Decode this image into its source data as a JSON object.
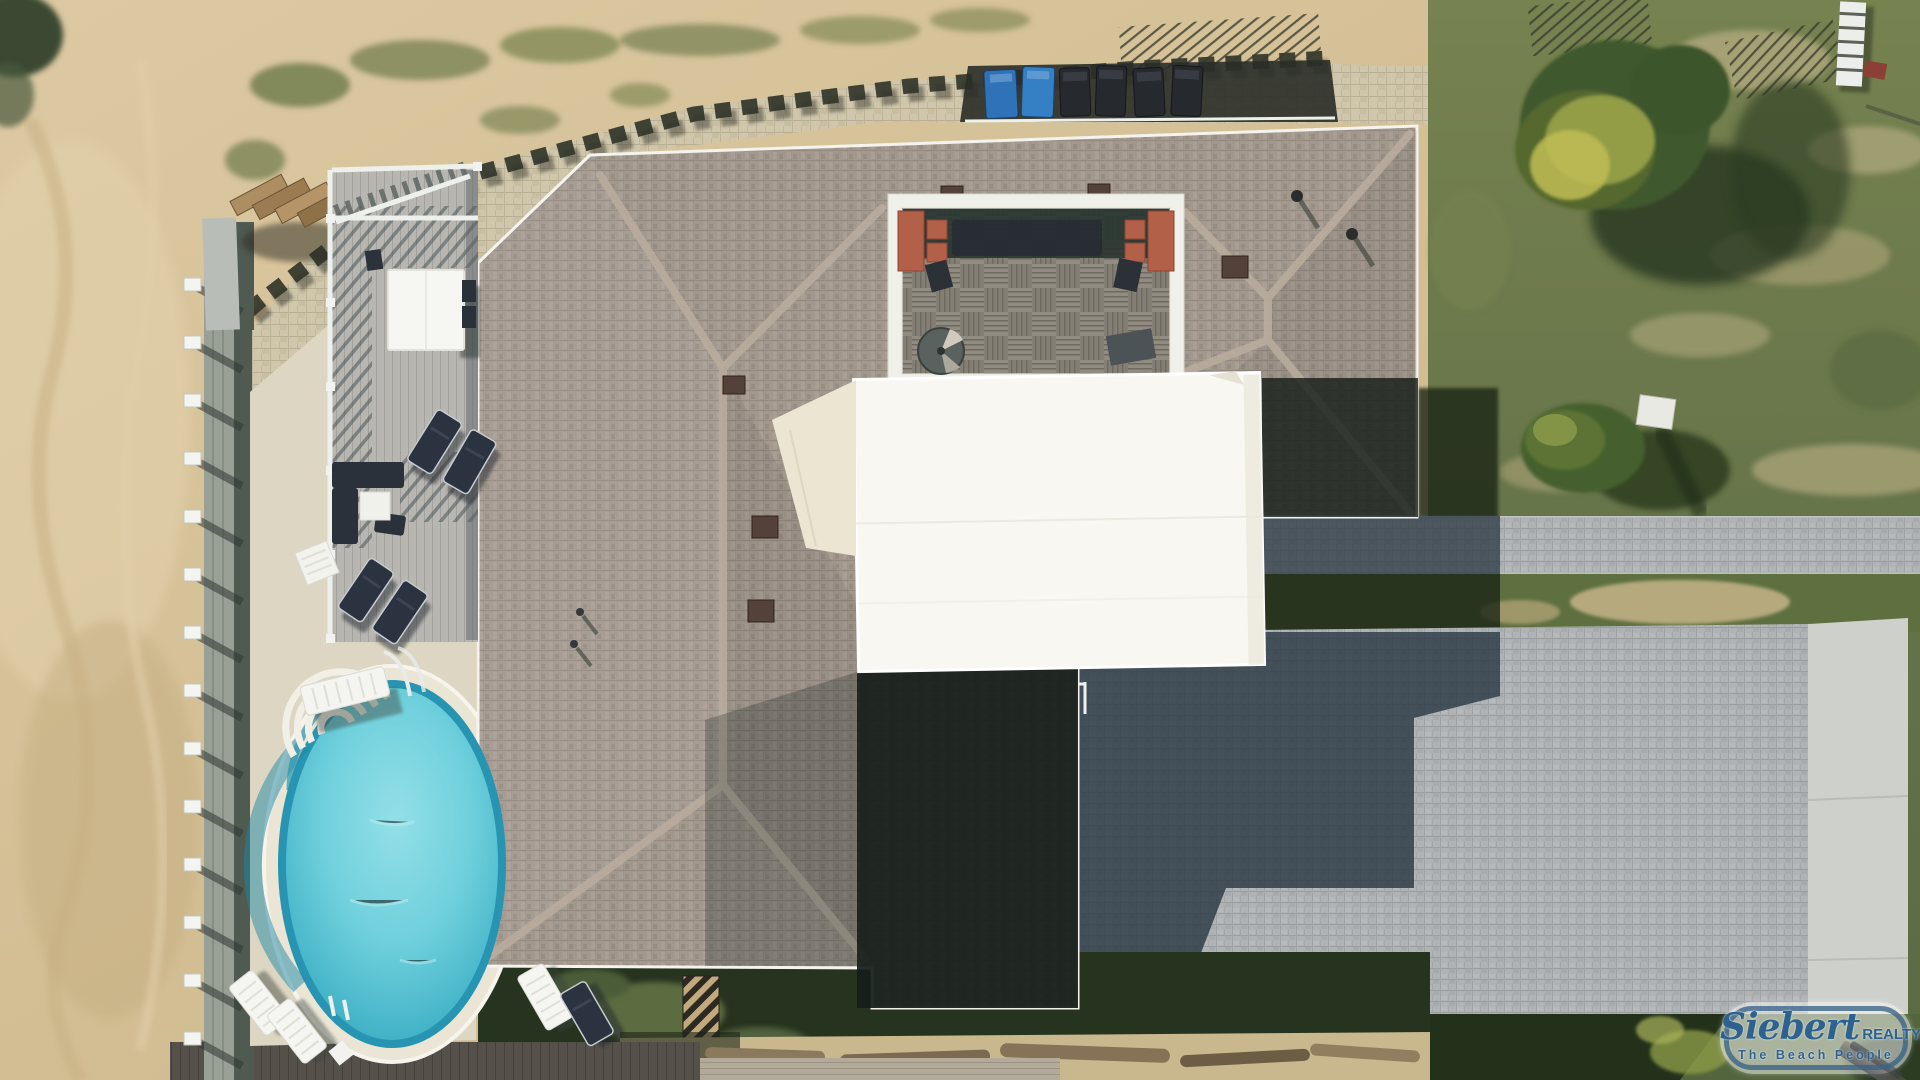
{
  "watermark": {
    "brand": "Siebert",
    "brand_suffix": "REALTY",
    "tagline": "The Beach People"
  },
  "scene": {
    "type": "aerial-drone-photo",
    "subject": "beachfront house with pool, sun deck, rooftop courtyard and paver patio"
  },
  "palette": {
    "beach_sand": "#d2bd92",
    "grass_lit": "#66744a",
    "grass_shadow": "#1c2616",
    "roof_shingle": "#a2988e",
    "ridge_cap": "#b9ac9d",
    "gutter_white": "#f4f3ee",
    "pool_water": "#46b5c9",
    "pool_steps": "#f2f0e6",
    "pool_deck": "#ddd6c3",
    "pavers_beige": "#cfc6ab",
    "pavers_gray": "#b0b3b5",
    "canopy_white": "#f8f7f2",
    "awning_cream": "#ece5d2",
    "courtyard_bench_red": "#b26048",
    "bin_blue": "#3580c4",
    "bin_black": "#26292d",
    "deck_wood": "#b8b6b1",
    "lounger_navy": "#2b3340",
    "lounger_white": "#f5f5f1",
    "logo_blue": "#2d628f"
  },
  "objects": {
    "trash_bins": {
      "blue_count": 2,
      "black_count": 4
    },
    "pool": "oval with fan steps and handrail",
    "spiral_staircase": 1
  }
}
